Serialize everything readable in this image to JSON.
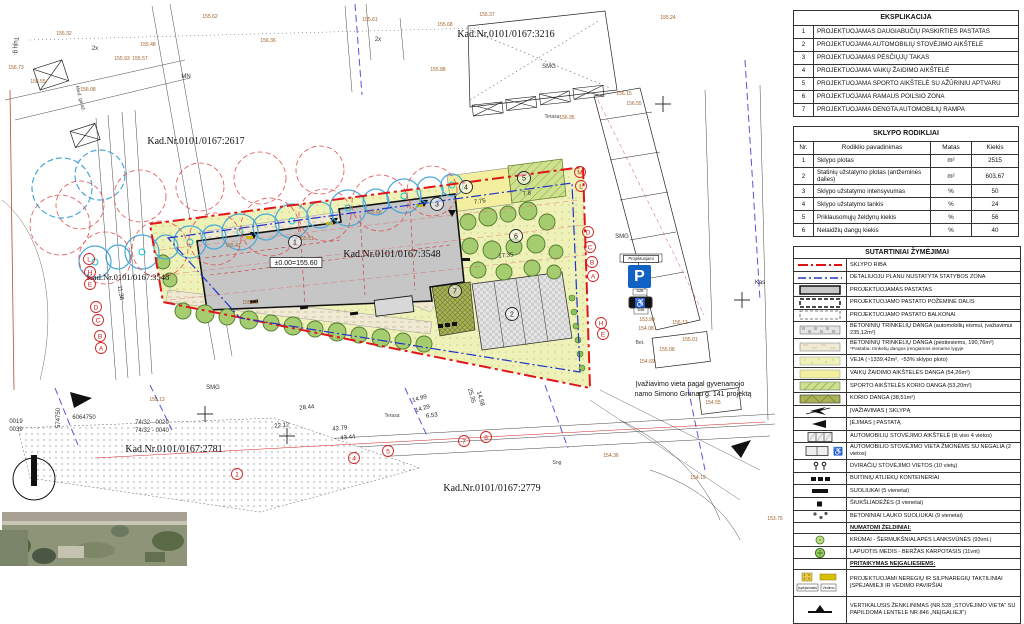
{
  "panel": {
    "eksplikacija": {
      "title": "EKSPLIKACIJA",
      "rows": [
        [
          "1",
          "PROJEKTUOJAMAS DAUGIABUČIŲ PASKIRTIES PASTATAS"
        ],
        [
          "2",
          "PROJEKTUOJAMA AUTOMOBILIŲ STOVĖJIMO AIKŠTELĖ"
        ],
        [
          "3",
          "PROJEKTUOJAMAS PĖSČIŲJŲ TAKAS"
        ],
        [
          "4",
          "PROJEKTUOJAMA VAIKŲ ŽAIDIMO AIKŠTELĖ"
        ],
        [
          "5",
          "PROJEKTUOJAMA SPORTO AIKŠTELĖ SU AŽŪRINIU APTVARU"
        ],
        [
          "6",
          "PROJEKTUOJAMA RAMAUS POILSIO ZONA"
        ],
        [
          "7",
          "PROJEKTUOJAMA DENGTA  AUTOMOBILIŲ RAMPA"
        ]
      ]
    },
    "rodikliai": {
      "title": "SKLYPO RODIKLIAI",
      "headers": [
        "Nr.",
        "Rodiklio pavadinimas",
        "Matas",
        "Kiekis"
      ],
      "rows": [
        [
          "1",
          "Sklypo plotas",
          "m²",
          "2515"
        ],
        [
          "2",
          "Statinių užstatymo plotas (antžeminės dalies)",
          "m²",
          "603,67"
        ],
        [
          "3",
          "Sklypo užstatymo intensyvumas",
          "%",
          "50"
        ],
        [
          "4",
          "Sklypo užstatymo tankis",
          "%",
          "24"
        ],
        [
          "5",
          "Priklausomųjų želdynų kiekis",
          "%",
          "56"
        ],
        [
          "6",
          "Nelaidžių dangų kiekis",
          "%",
          "40"
        ]
      ]
    },
    "zymejimai": {
      "title": "SUTARTINIAI ŽYMĖJIMAI",
      "rows": [
        {
          "sym": "red-dashdot-line",
          "text": "SKLYPO RIBA"
        },
        {
          "sym": "blue-dashdot-line",
          "text": "DETALIUOJU PLANU NUSTATYTA STATYBOS ZONA"
        },
        {
          "sym": "building-swatch",
          "text": "PROJEKTUOJAMAS PASTATAS"
        },
        {
          "sym": "underground-swatch",
          "text": "PROJEKTUOJAMO PASTATO POŽEMINĖ DALIS"
        },
        {
          "sym": "balcony-swatch",
          "text": "PROJEKTUOJAMO PASTATO BALKONAI"
        },
        {
          "sym": "pavers-drive-swatch",
          "text": "BETONINIŲ TRINKELIŲ DANGA (automobilių eismui, įvažiavimui 235,12m²)"
        },
        {
          "sym": "pavers-ped-swatch",
          "text": "BETONINIŲ TRINKELIŲ DANGA (pėstiesiems, 190,76m²)",
          "note": "*Pastaba: trinkelių dangos įrengiamos viename lygyje"
        },
        {
          "sym": "lawn-swatch",
          "text": "VEJA (~1339,42m², ~53% sklypo ploto)"
        },
        {
          "sym": "playground-swatch",
          "text": "VAIKŲ ŽAIDIMO AIKŠTELĖS DANGA (54,26m²)"
        },
        {
          "sym": "sport-swatch",
          "text": "SPORTO AIKŠTELĖS KORIO DANGA (53,20m²)"
        },
        {
          "sym": "korio-swatch",
          "text": "KORIO DANGA (38,51m²)"
        },
        {
          "sym": "site-entry-icon",
          "text": "ĮVAŽIAVIMAS Į SKLYPĄ"
        },
        {
          "sym": "building-entry-icon",
          "text": "ĮĖJIMAS Į PASTATĄ"
        },
        {
          "sym": "parking-icon",
          "text": "AUTOMOBILIŲ STOVĖJIMO AIKŠTELĖ (iš viso 4 vietos)"
        },
        {
          "sym": "parking-disabled-icon",
          "text": "AUTOMOBILIO STOVĖJIMO VIETA ŽMONĖMS SU NEGALIA (2 vietos)"
        },
        {
          "sym": "bike-parking-icon",
          "text": "DVIRAČIŲ STOVĖJIMO VIETOS (10 vietų)"
        },
        {
          "sym": "waste-container-icon",
          "text": "BUITINIŲ ATLIEKŲ KONTEINERIAI"
        },
        {
          "sym": "bench-icon",
          "text": "SUOLIUKAI  (5 vienetai)"
        },
        {
          "sym": "trash-bin-icon",
          "text": "ŠIUKŠLIADĖŽĖS  (3 vienetai)"
        },
        {
          "sym": "concrete-bench-icon",
          "text": "BETONINIAI LAUKO SUOLIUKAI  (9 vienetai)"
        },
        {
          "head": true,
          "text": "NUMATOMI ŽELDINIAI:"
        },
        {
          "sym": "shrub-icon",
          "text": "KRŪMAI - ŠERMUKŠNIALAPĖS LANKSVŪNĖS (93vnt.)"
        },
        {
          "sym": "tree-icon",
          "text": "LAPUOTIS MEDIS - BERŽAS KARPOTASIS (11vnt)"
        },
        {
          "head": true,
          "text": "PRITAIKYMAS NEĮGALIESIEMS:"
        },
        {
          "sym": "tactile-icon",
          "tall": true,
          "text": "PROJEKTUOJAMI NEREGIŲ IR SILPNAREGIŲ TAKTILINIAI ĮSPĖJAMIEJI IR VEDIMO PAVIRŠIAI"
        },
        {
          "sym": "vertical-sign-icon",
          "tall": true,
          "text": "VERTIKALUSIS ŽENKLINIMAS (NR.528 „STOVĖJIMO VIETA“ SU PAPILDOMA LENTELE NR.846 „NEĮGALIEJI“)"
        }
      ],
      "tactile_labels": [
        "Įspėjamasis",
        "Vedimo"
      ]
    }
  },
  "map": {
    "parking_sign": {
      "top_label": "Projektuojami",
      "letter": "P",
      "sign_no": "528",
      "extra_no": "846",
      "wheelchair": "♿"
    },
    "labels": [
      {
        "t": "Kad.Nr.0101/0167:3216",
        "x": 506,
        "y": 37,
        "cls": "cad"
      },
      {
        "t": "Kad.Nr.0101/0167:2617",
        "x": 196,
        "y": 144,
        "cls": "cad"
      },
      {
        "t": "Kad.Nr.0101/0167:3548",
        "x": 392,
        "y": 257,
        "cls": "cad"
      },
      {
        "t": "Kad.Nr.0101/0167:2781",
        "x": 174,
        "y": 452,
        "cls": "cad"
      },
      {
        "t": "Kad.Nr.0101/0167:2779",
        "x": 492,
        "y": 491,
        "cls": "cad"
      },
      {
        "t": "Kad.Nr.0101/0167:3548",
        "x": 128,
        "y": 280,
        "cls": "cads"
      },
      {
        "t": "±0.00=155.60",
        "x": 296,
        "y": 265,
        "cls": "n7",
        "box": 1
      },
      {
        "t": "Įvažiavimo vieta pagal gyvenamojo",
        "x": 690,
        "y": 386,
        "cls": "n7"
      },
      {
        "t": "namo Simono Grunau g. 141 projektą",
        "x": 693,
        "y": 396,
        "cls": "n7"
      },
      {
        "t": "74/32 - 0020",
        "x": 152,
        "y": 424,
        "cls": "n6"
      },
      {
        "t": "74/32 - 0040",
        "x": 152,
        "y": 432,
        "cls": "n6"
      },
      {
        "t": "0019",
        "x": 16,
        "y": 423,
        "cls": "n6"
      },
      {
        "t": "0039",
        "x": 16,
        "y": 431,
        "cls": "n6"
      },
      {
        "t": "574750",
        "x": 60,
        "y": 418,
        "cls": "n6",
        "rot": -90
      },
      {
        "t": "6064750",
        "x": 84,
        "y": 419,
        "cls": "n6"
      },
      {
        "t": "SMG",
        "x": 549,
        "y": 68,
        "cls": "n6"
      },
      {
        "t": "SMG",
        "x": 622,
        "y": 238,
        "cls": "n6"
      },
      {
        "t": "SMG",
        "x": 213,
        "y": 389,
        "cls": "n6"
      },
      {
        "t": "MN",
        "x": 186,
        "y": 78,
        "cls": "n6"
      },
      {
        "t": "2x",
        "x": 95,
        "y": 50,
        "cls": "n6"
      },
      {
        "t": "2x",
        "x": 378,
        "y": 41,
        "cls": "n6"
      },
      {
        "t": "Kas",
        "x": 760,
        "y": 284,
        "cls": "n6"
      },
      {
        "t": "Terasa",
        "x": 552,
        "y": 118,
        "cls": "n5"
      },
      {
        "t": "Terasa",
        "x": 392,
        "y": 417,
        "cls": "n5"
      },
      {
        "t": "Bet.",
        "x": 640,
        "y": 344,
        "cls": "n5"
      },
      {
        "t": "Sng",
        "x": 557,
        "y": 464,
        "cls": "n5"
      },
      {
        "t": "Tujų g.",
        "x": 14,
        "y": 46,
        "cls": "n6",
        "rot": 90
      },
      {
        "t": "Med. garaž.",
        "x": 79,
        "y": 99,
        "cls": "n5",
        "rot": 75
      },
      {
        "t": "Projektuojami",
        "x": 641,
        "y": 260,
        "cls": "n4",
        "box": 1
      },
      {
        "t": "528",
        "x": 640,
        "y": 292,
        "cls": "n4"
      },
      {
        "t": "846",
        "x": 641,
        "y": 311,
        "cls": "n4"
      },
      {
        "t": "28.44",
        "x": 307,
        "y": 409,
        "cls": "dim",
        "rot": -6
      },
      {
        "t": "22.12",
        "x": 282,
        "y": 427,
        "cls": "dim",
        "rot": -6
      },
      {
        "t": "43.44",
        "x": 348,
        "y": 439,
        "cls": "dim",
        "rot": -6
      },
      {
        "t": "42.79",
        "x": 340,
        "y": 430,
        "cls": "dim",
        "rot": -6
      },
      {
        "t": "6.53",
        "x": 432,
        "y": 417,
        "cls": "dim",
        "rot": -6
      },
      {
        "t": "14.99",
        "x": 420,
        "y": 400,
        "cls": "dim",
        "rot": -16
      },
      {
        "t": "14.29",
        "x": 423,
        "y": 410,
        "cls": "dim",
        "rot": -16
      },
      {
        "t": "7.75",
        "x": 480,
        "y": 203,
        "cls": "dim",
        "rot": -8
      },
      {
        "t": "7.8",
        "x": 527,
        "y": 195,
        "cls": "dim",
        "rot": -8
      },
      {
        "t": "17.35",
        "x": 506,
        "y": 257,
        "cls": "dim",
        "rot": -5
      },
      {
        "t": "11.38",
        "x": 119,
        "y": 293,
        "cls": "dim",
        "rot": 80
      },
      {
        "t": "25.35",
        "x": 470,
        "y": 396,
        "cls": "dim",
        "rot": 75
      },
      {
        "t": "14.58",
        "x": 479,
        "y": 399,
        "cls": "dim",
        "rot": 75
      },
      {
        "t": "155.48",
        "x": 148,
        "y": 46,
        "cls": "elev"
      },
      {
        "t": "155.57",
        "x": 140,
        "y": 60,
        "cls": "elev"
      },
      {
        "t": "155.62",
        "x": 210,
        "y": 18,
        "cls": "elev"
      },
      {
        "t": "155.61",
        "x": 370,
        "y": 21,
        "cls": "elev"
      },
      {
        "t": "155.37",
        "x": 487,
        "y": 16,
        "cls": "elev"
      },
      {
        "t": "155.24",
        "x": 668,
        "y": 19,
        "cls": "elev"
      },
      {
        "t": "156.36",
        "x": 268,
        "y": 42,
        "cls": "elev"
      },
      {
        "t": "156.73",
        "x": 16,
        "y": 69,
        "cls": "elev"
      },
      {
        "t": "156.55",
        "x": 38,
        "y": 83,
        "cls": "elev"
      },
      {
        "t": "156.32",
        "x": 64,
        "y": 35,
        "cls": "elev"
      },
      {
        "t": "156.08",
        "x": 88,
        "y": 91,
        "cls": "elev"
      },
      {
        "t": "155.93",
        "x": 122,
        "y": 60,
        "cls": "elev"
      },
      {
        "t": "155.68",
        "x": 445,
        "y": 26,
        "cls": "elev"
      },
      {
        "t": "155.88",
        "x": 438,
        "y": 71,
        "cls": "elev"
      },
      {
        "t": "156.15",
        "x": 624,
        "y": 95,
        "cls": "elev"
      },
      {
        "t": "156.55",
        "x": 634,
        "y": 105,
        "cls": "elev"
      },
      {
        "t": "156.95",
        "x": 567,
        "y": 119,
        "cls": "elev"
      },
      {
        "t": "153.90",
        "x": 647,
        "y": 321,
        "cls": "elev"
      },
      {
        "t": "154.08",
        "x": 646,
        "y": 330,
        "cls": "elev"
      },
      {
        "t": "155.13",
        "x": 680,
        "y": 324,
        "cls": "elev"
      },
      {
        "t": "155.01",
        "x": 690,
        "y": 341,
        "cls": "elev"
      },
      {
        "t": "155.08",
        "x": 667,
        "y": 351,
        "cls": "elev"
      },
      {
        "t": "154.69",
        "x": 647,
        "y": 363,
        "cls": "elev"
      },
      {
        "t": "154.36",
        "x": 611,
        "y": 457,
        "cls": "elev"
      },
      {
        "t": "154.55",
        "x": 713,
        "y": 404,
        "cls": "elev"
      },
      {
        "t": "153.75",
        "x": 775,
        "y": 520,
        "cls": "elev"
      },
      {
        "t": "155.41",
        "x": 233,
        "y": 247,
        "cls": "elev"
      },
      {
        "t": "155.51",
        "x": 306,
        "y": 240,
        "cls": "elev"
      },
      {
        "t": "155.68",
        "x": 374,
        "y": 214,
        "cls": "elev"
      },
      {
        "t": "155.63",
        "x": 250,
        "y": 304,
        "cls": "elev"
      },
      {
        "t": "155.13",
        "x": 157,
        "y": 401,
        "cls": "elev"
      },
      {
        "t": "154.19",
        "x": 698,
        "y": 479,
        "cls": "elev"
      }
    ],
    "axis_marks": [
      {
        "t": "L",
        "x": 89,
        "y": 259
      },
      {
        "t": "H",
        "x": 90,
        "y": 272
      },
      {
        "t": "E",
        "x": 90,
        "y": 284
      },
      {
        "t": "D",
        "x": 96,
        "y": 307
      },
      {
        "t": "C",
        "x": 98,
        "y": 320
      },
      {
        "t": "B",
        "x": 100,
        "y": 336
      },
      {
        "t": "A",
        "x": 101,
        "y": 348
      },
      {
        "t": "M",
        "x": 580,
        "y": 172
      },
      {
        "t": "L",
        "x": 581,
        "y": 186
      },
      {
        "t": "D",
        "x": 588,
        "y": 232
      },
      {
        "t": "C",
        "x": 590,
        "y": 247
      },
      {
        "t": "B",
        "x": 592,
        "y": 262
      },
      {
        "t": "A",
        "x": 593,
        "y": 276
      },
      {
        "t": "H",
        "x": 601,
        "y": 323
      },
      {
        "t": "E",
        "x": 603,
        "y": 334
      },
      {
        "t": "1",
        "x": 237,
        "y": 474
      },
      {
        "t": "4",
        "x": 354,
        "y": 458
      },
      {
        "t": "5",
        "x": 388,
        "y": 451
      },
      {
        "t": "7",
        "x": 464,
        "y": 441
      },
      {
        "t": "8",
        "x": 486,
        "y": 437
      }
    ],
    "ref_numbers": [
      {
        "t": "1",
        "x": 295,
        "y": 242
      },
      {
        "t": "2",
        "x": 512,
        "y": 314
      },
      {
        "t": "3",
        "x": 437,
        "y": 204
      },
      {
        "t": "4",
        "x": 466,
        "y": 187
      },
      {
        "t": "5",
        "x": 524,
        "y": 178
      },
      {
        "t": "6",
        "x": 516,
        "y": 236
      },
      {
        "t": "7",
        "x": 455,
        "y": 291
      }
    ]
  },
  "colors": {
    "plot_boundary_red": "#e0151a",
    "statybos_zona_blue": "#2233cc",
    "building_gray": "#c8c8c8",
    "lawn_yellow": "#eff2b8",
    "parking_sign_blue": "#1261c4",
    "tree_green": "#9ccf60",
    "existing_tree_blue": "#49a8d8",
    "crown_red": "#e05050"
  }
}
